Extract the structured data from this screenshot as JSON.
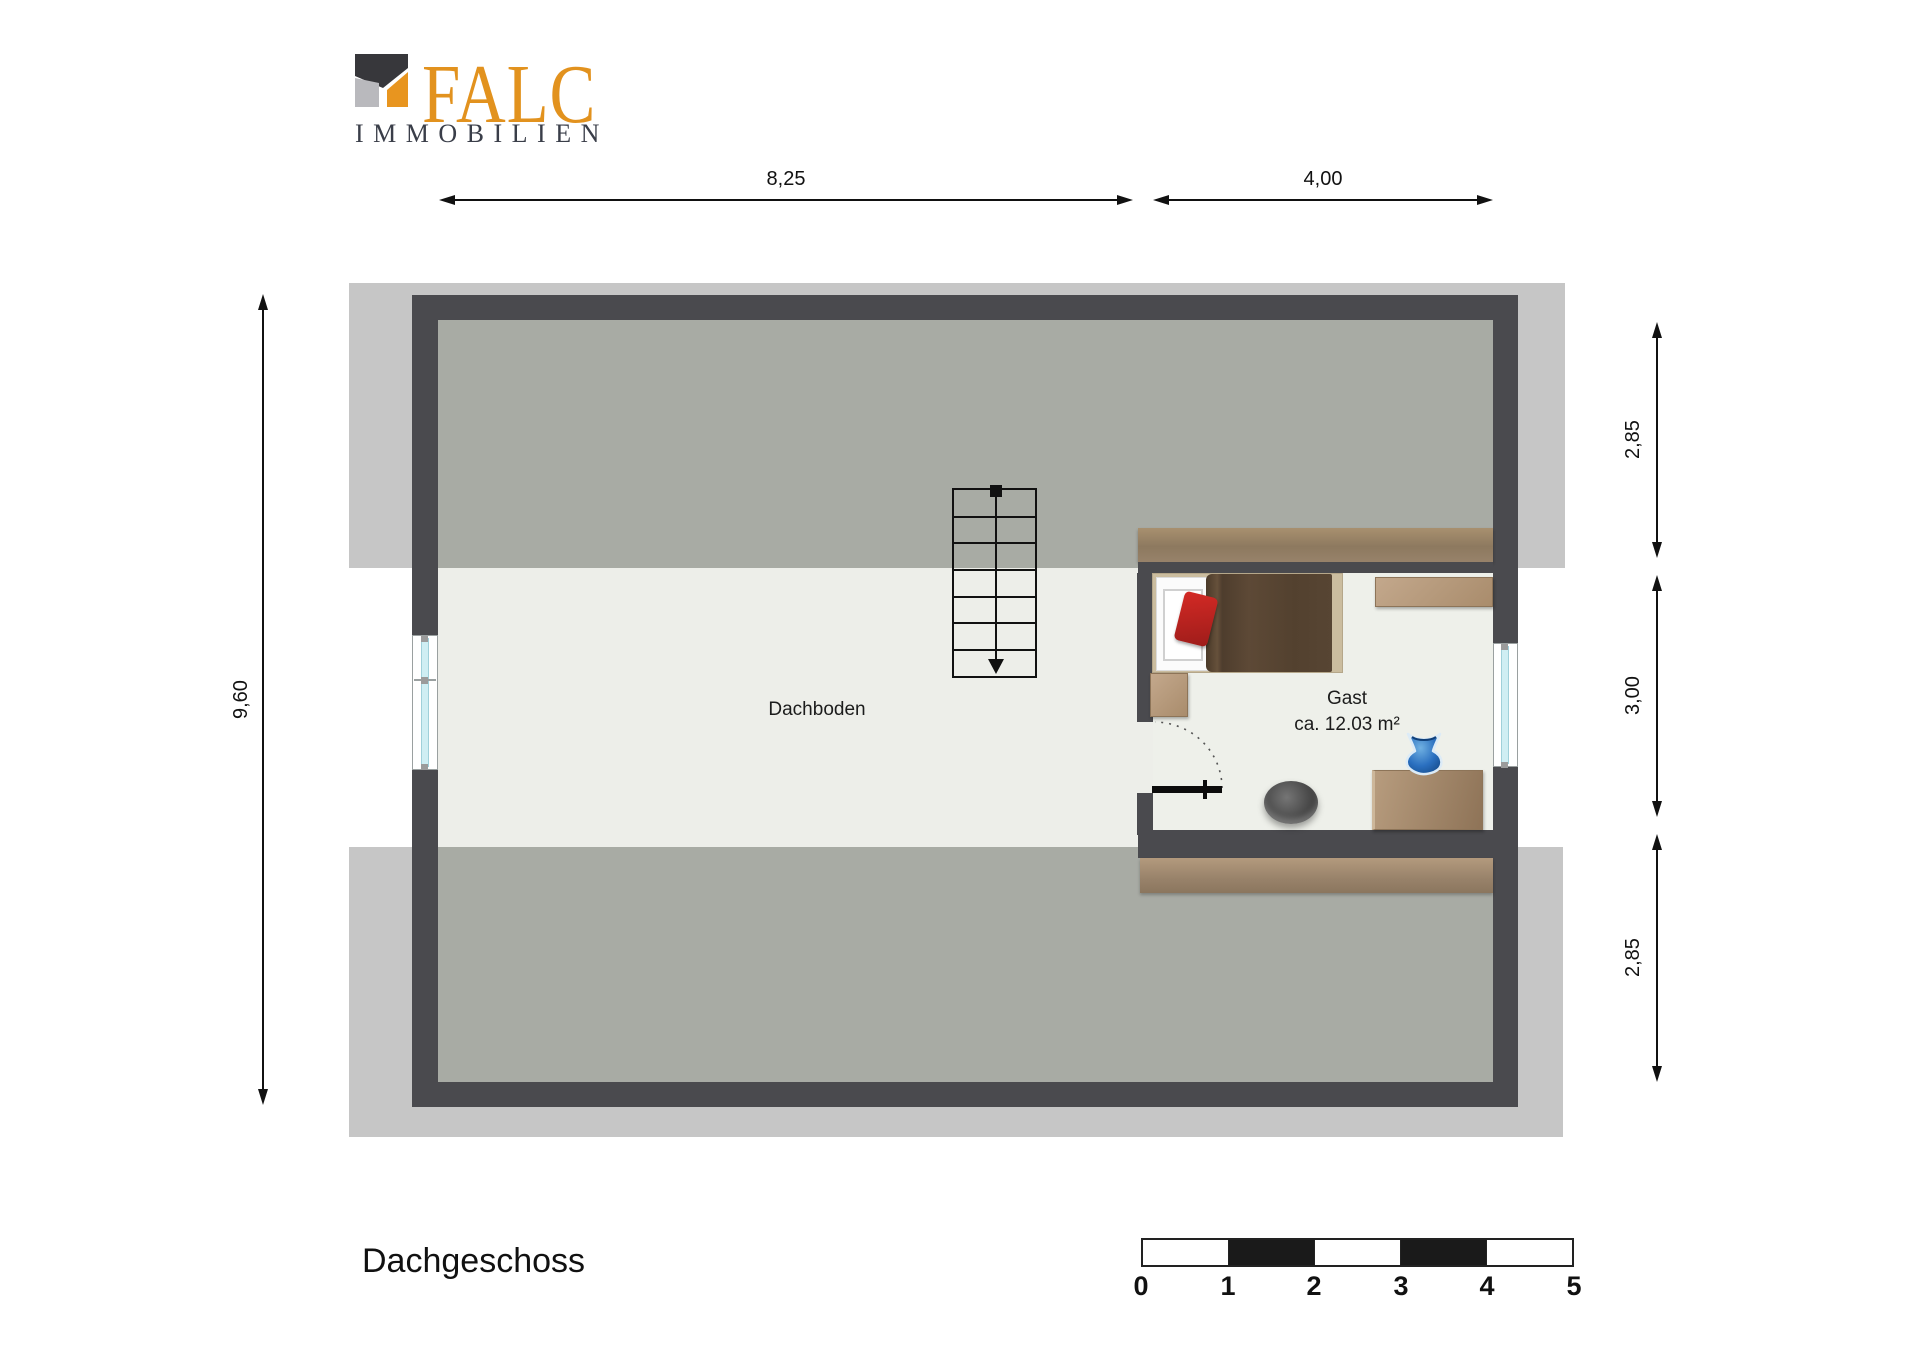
{
  "logo": {
    "brand": "FALC",
    "subtitle": "IMMOBILIEN",
    "accent_color": "#E2921E",
    "icon_dark": "#37373B",
    "icon_light": "#B9B9BD"
  },
  "dimensions": {
    "top": [
      {
        "label": "8,25"
      },
      {
        "label": "4,00"
      }
    ],
    "left": [
      {
        "label": "9,60"
      }
    ],
    "right": [
      {
        "label": "2,85"
      },
      {
        "label": "3,00"
      },
      {
        "label": "2,85"
      }
    ]
  },
  "rooms": [
    {
      "name": "Dachboden",
      "area": ""
    },
    {
      "name": "Gast",
      "area": "ca. 12.03 m²"
    }
  ],
  "floor_label": "Dachgeschoss",
  "scale_bar": {
    "ticks": [
      "0",
      "1",
      "2",
      "3",
      "4",
      "5"
    ]
  },
  "colors": {
    "wall": "#4A4A4E",
    "roof_overhang": "#C6C6C6",
    "floor_under_slope": "#A8ABA4",
    "floor_full_height": "#EDEEE9",
    "room_floor": "#EEF0EA",
    "wood": "#A8906F",
    "bed_blanket": "#584531",
    "pillow_red": "#C32222",
    "vase_blue": "#2A6FBF",
    "window_glass": "#CFEEF3"
  }
}
